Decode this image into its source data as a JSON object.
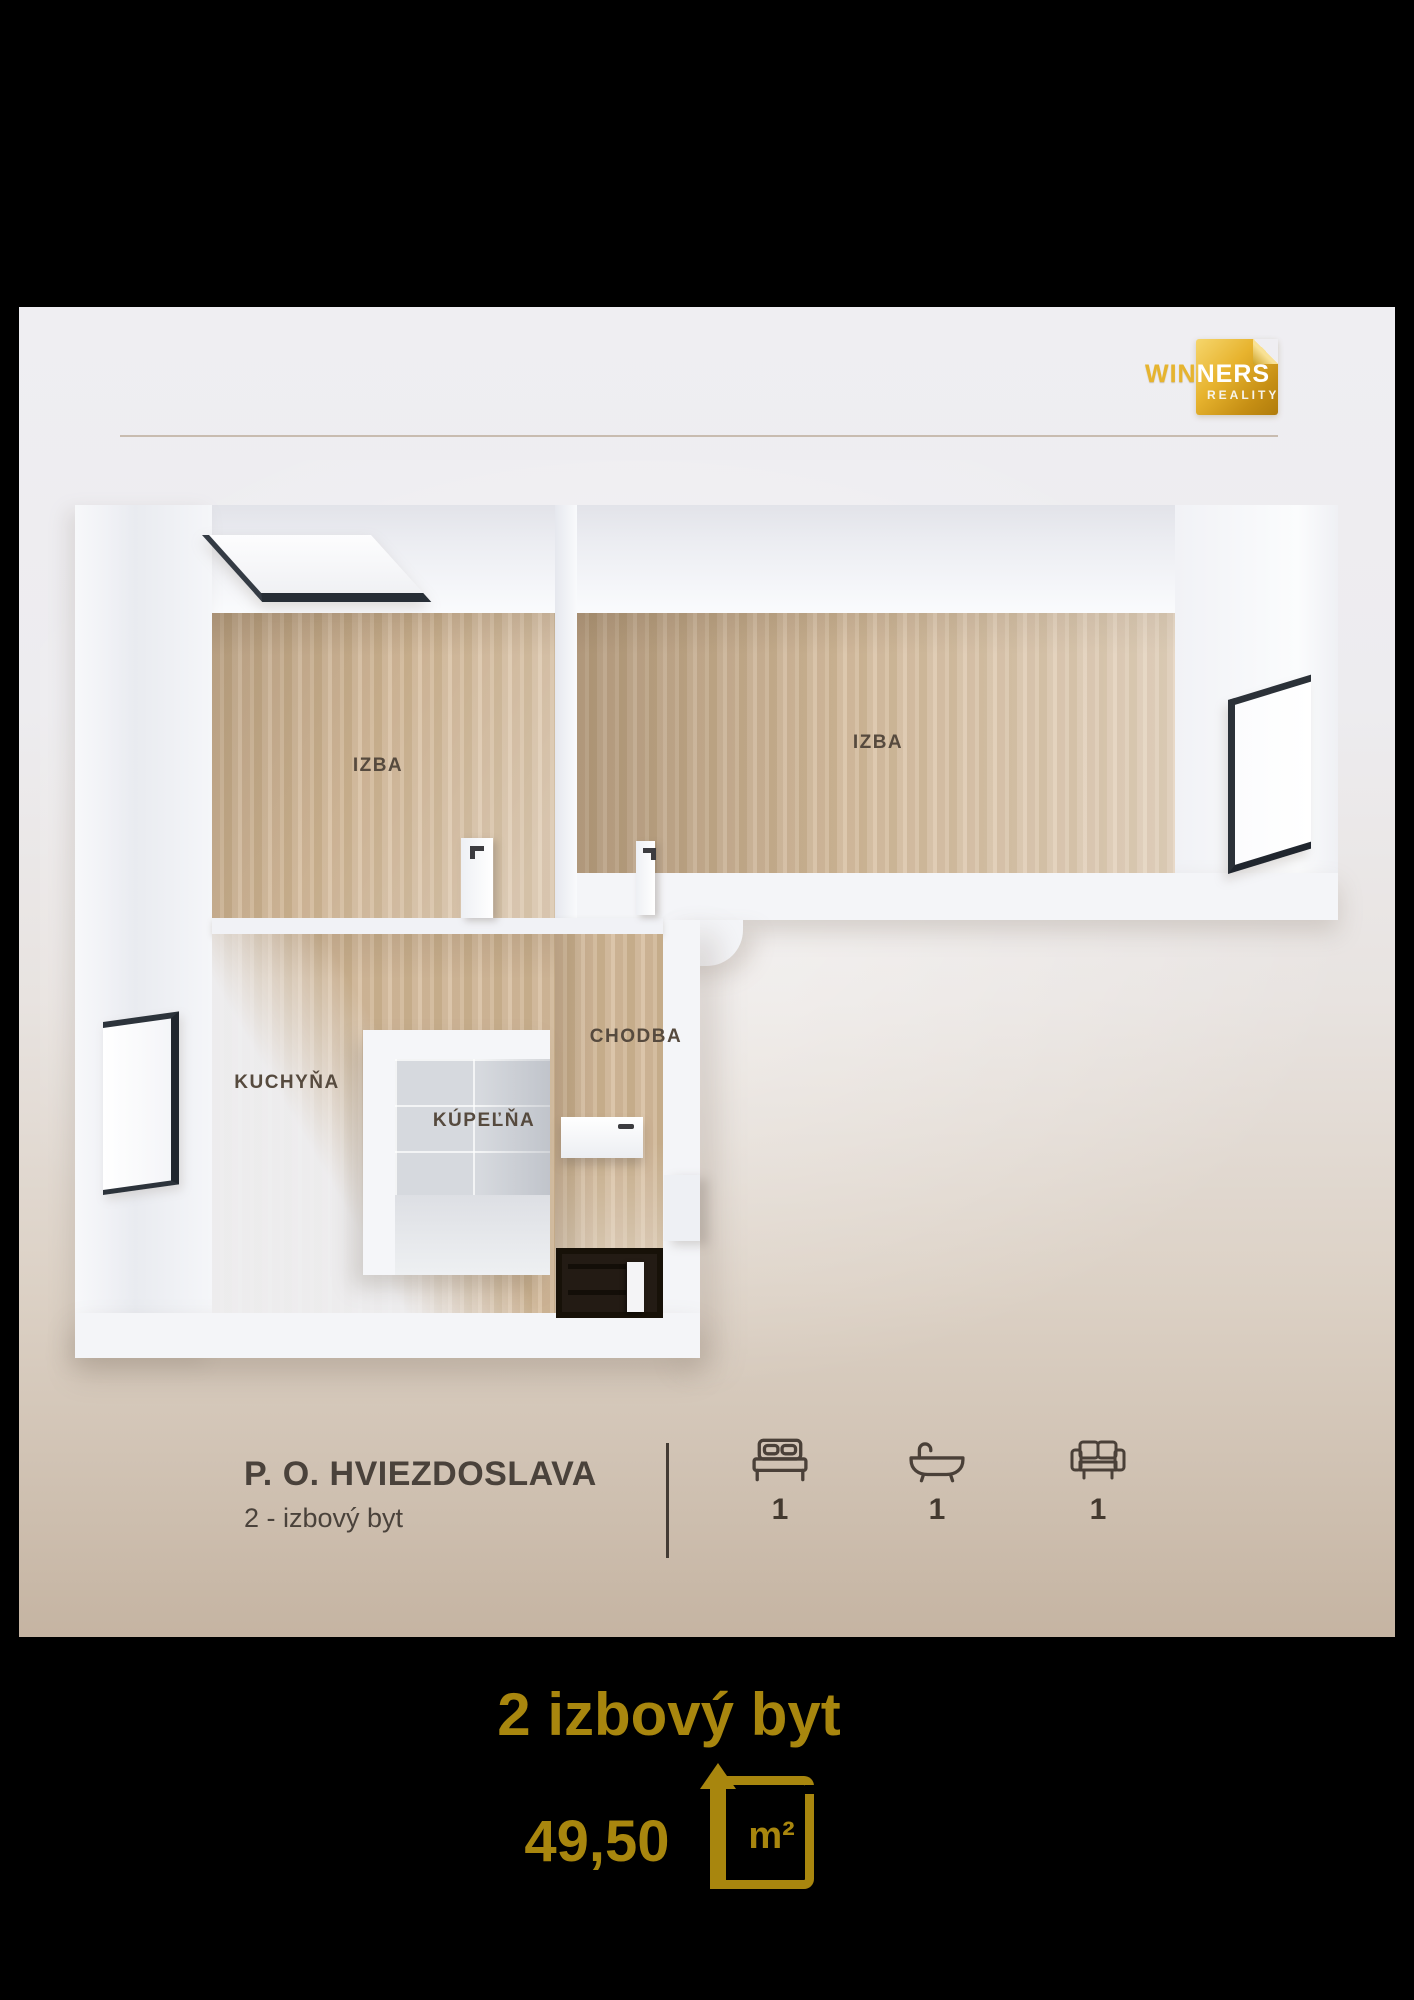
{
  "brand": {
    "name_prefix": "WIN",
    "name_suffix": "NERS",
    "tagline": "REALITY"
  },
  "plan": {
    "rooms": [
      {
        "id": "izba-left",
        "label": "IZBA"
      },
      {
        "id": "izba-right",
        "label": "IZBA"
      },
      {
        "id": "kuchyna",
        "label": "KUCHYŇA"
      },
      {
        "id": "kupelna",
        "label": "KÚPEĽŇA"
      },
      {
        "id": "chodba",
        "label": "CHODBA"
      }
    ]
  },
  "listing": {
    "address": "P. O. HVIEZDOSLAVA",
    "type": "2 - izbový byt",
    "features": [
      {
        "name": "bedrooms",
        "icon": "bed-icon",
        "count": "1"
      },
      {
        "name": "bathrooms",
        "icon": "bathtub-icon",
        "count": "1"
      },
      {
        "name": "living-rooms",
        "icon": "sofa-icon",
        "count": "1"
      }
    ]
  },
  "footer": {
    "title": "2 izbový byt",
    "area": "49,50",
    "unit": "m²"
  },
  "colors": {
    "gold": "#a8860e",
    "text_dark": "#4a423b",
    "room_label": "#564a3e",
    "card_top": "#efeef2",
    "card_bottom": "#c5b4a2",
    "wood": "#cfb596",
    "background": "#000000"
  }
}
